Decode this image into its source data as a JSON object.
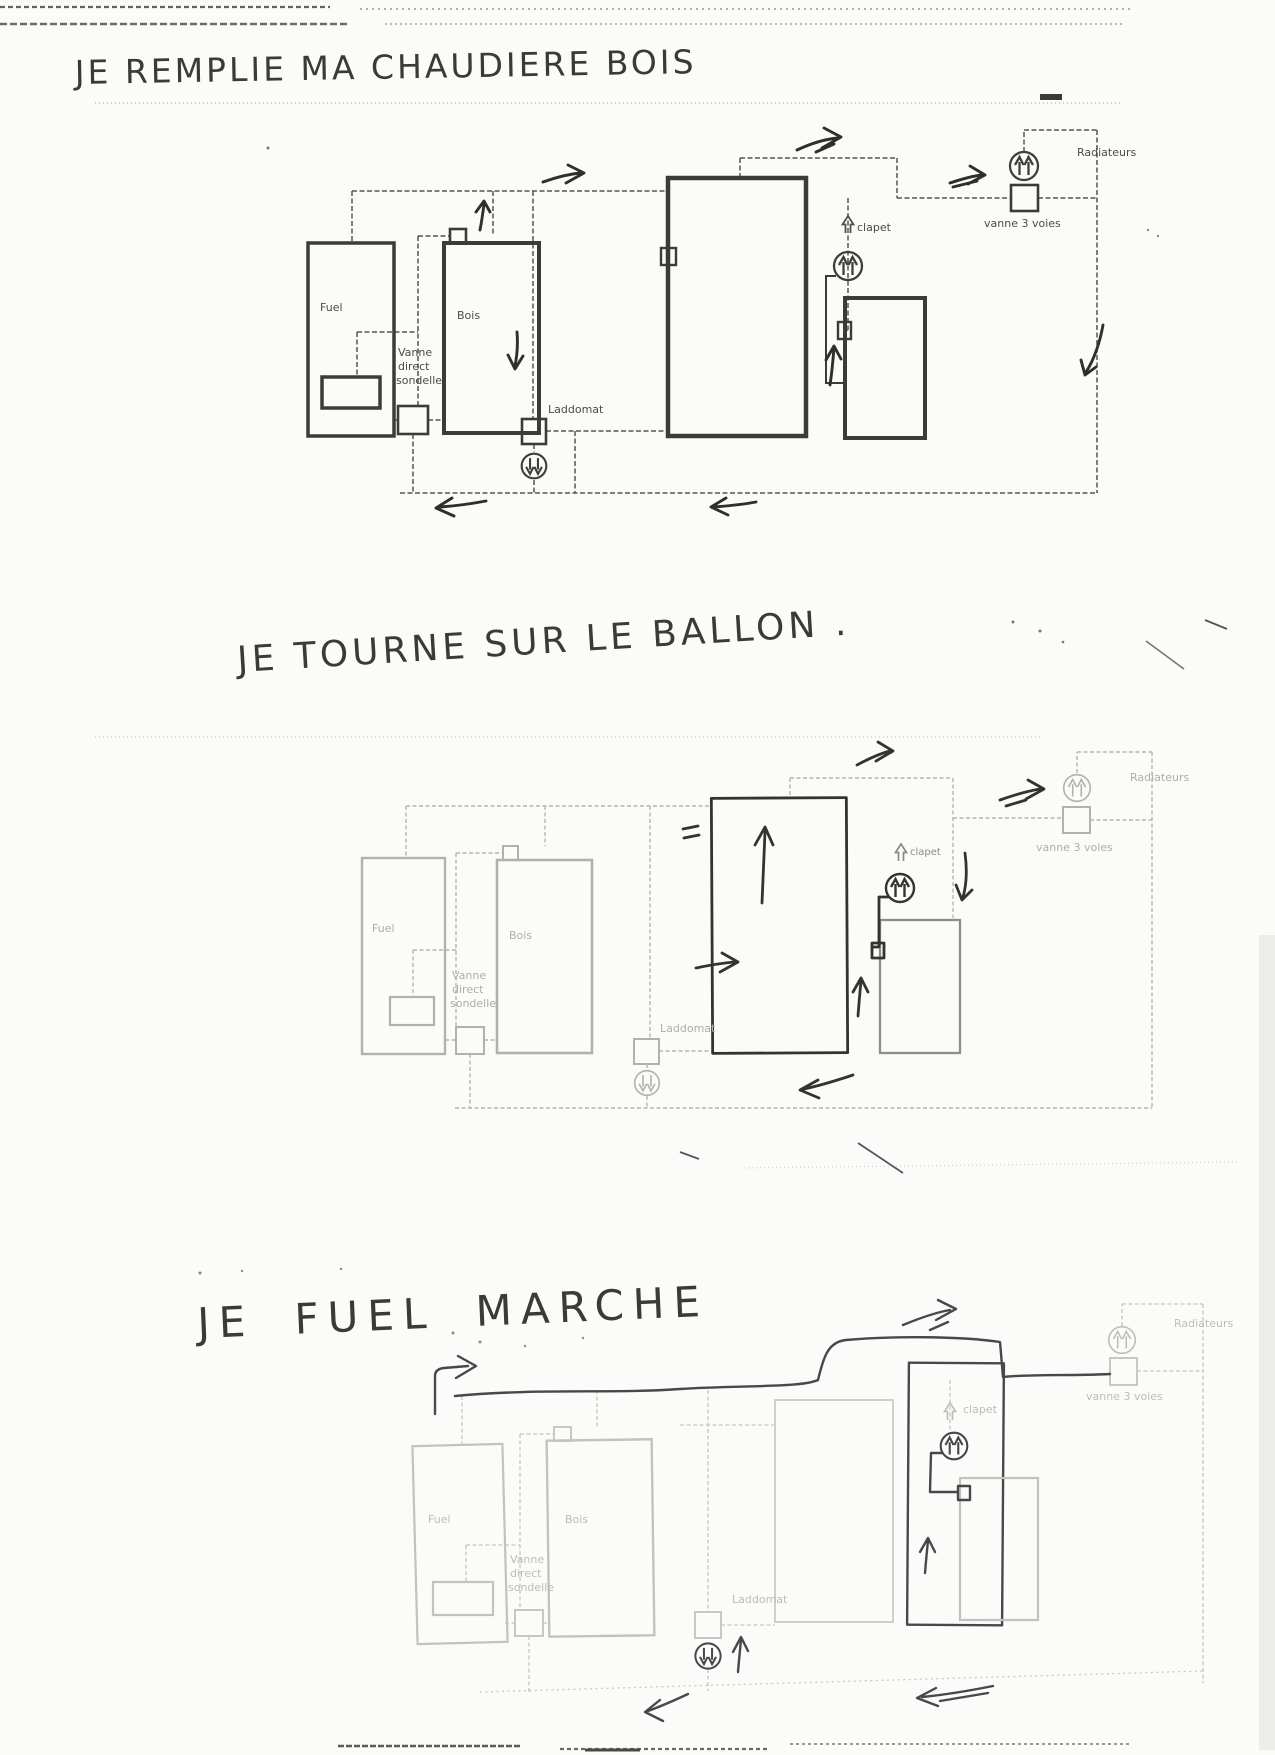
{
  "scan": {
    "paper_color": "#fbfbf9",
    "ink_color": "#2f2f2b",
    "print_dark_color": "#3c3c37",
    "print_faint_color": "#b2b2ac",
    "print_extra_faint_color": "#c3c3bd"
  },
  "diagrams": [
    {
      "title": "JE REMPLIE MA CHAUDIERE BOIS",
      "labels": {
        "fuel": "Fuel",
        "bois": "Bois",
        "vanne_l1": "Vanne",
        "vanne_l2": "direct",
        "vanne_l3": "sondelle",
        "laddomat": "Laddomat",
        "clapet": "clapet",
        "vanne3voies": "vanne 3 voies",
        "radiateurs": "Radiateurs"
      }
    },
    {
      "title": "JE TOURNE SUR LE BALLON .",
      "labels": {
        "fuel": "Fuel",
        "bois": "Bois",
        "vanne_l1": "Vanne",
        "vanne_l2": "direct",
        "vanne_l3": "sondelle",
        "laddomat": "Laddomat",
        "clapet": "clapet",
        "vanne3voies": "vanne 3 voies",
        "radiateurs": "Radiateurs"
      }
    },
    {
      "title": "JE FUEL MARCHE",
      "labels": {
        "fuel": "Fuel",
        "bois": "Bois",
        "vanne_l1": "Vanne",
        "vanne_l2": "direct",
        "vanne_l3": "sondelle",
        "laddomat": "Laddomat",
        "clapet": "clapet",
        "vanne3voies": "vanne 3 voies",
        "radiateurs": "Radiateurs"
      }
    }
  ]
}
